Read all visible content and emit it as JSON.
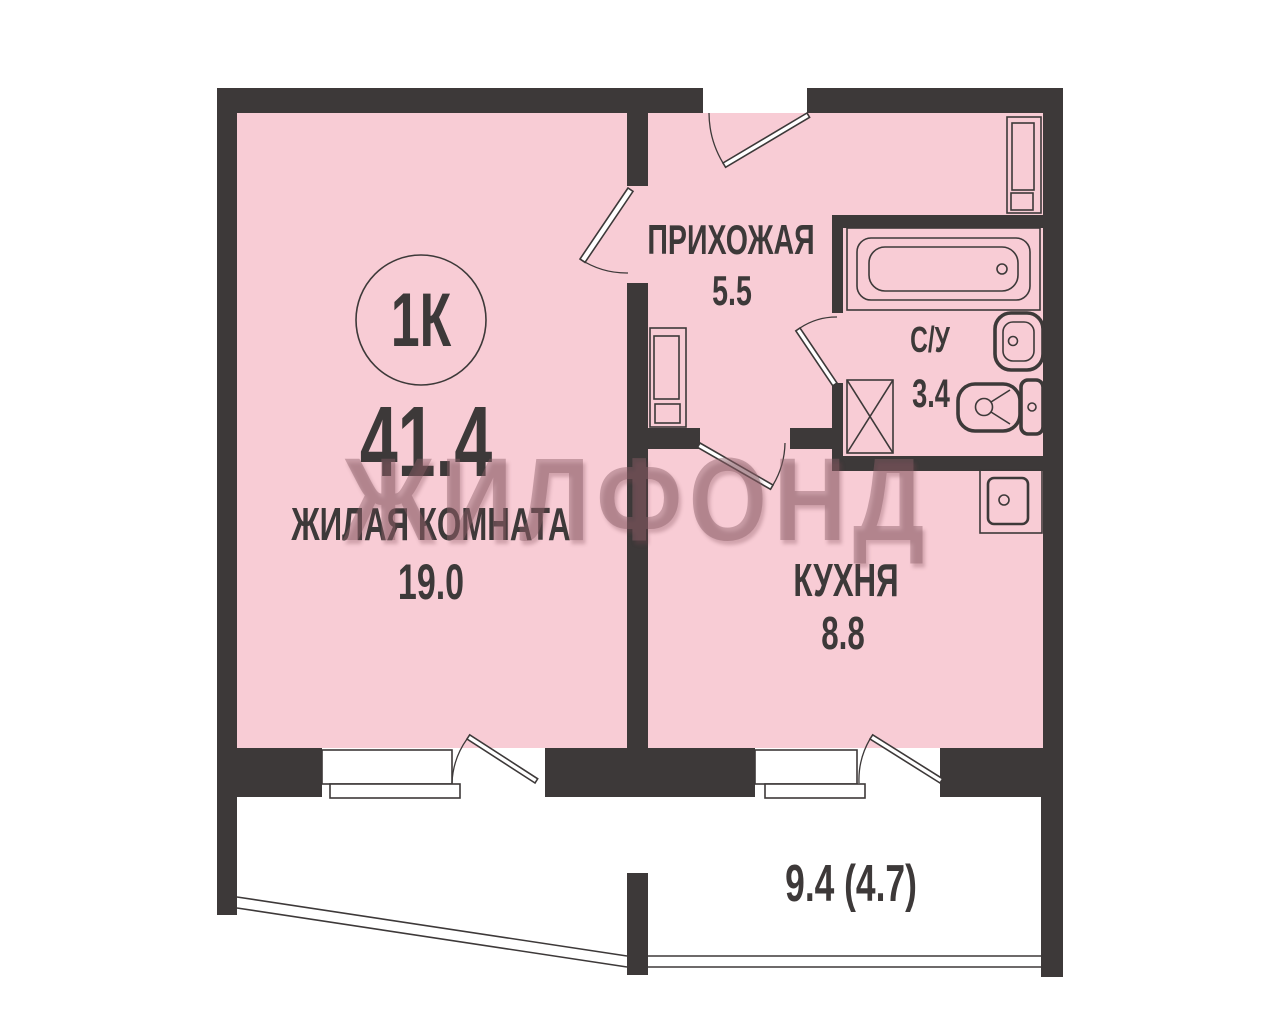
{
  "plan": {
    "type_badge": "1К",
    "total_area": "41.4",
    "watermark": "ЖИЛФОНД",
    "rooms": [
      {
        "name": "ЖИЛАЯ КОМНАТА",
        "area": "19.0"
      },
      {
        "name": "ПРИХОЖАЯ",
        "area": "5.5"
      },
      {
        "name": "С/У",
        "area": "3.4"
      },
      {
        "name": "КУХНЯ",
        "area": "8.8"
      }
    ],
    "balcony_area": "9.4 (4.7)",
    "fixtures": [
      "bathtub-icon",
      "wc-sink-icon",
      "toilet-icon",
      "shower-box-icon",
      "kitchen-sink-icon",
      "hall-cabinet-icon",
      "wardrobe-icon",
      "window-icon",
      "door-swing-icon",
      "balcony-railing-icon"
    ]
  },
  "colors": {
    "bg": "#ffffff",
    "wall": "#3d3939",
    "room": "#f8ccd5",
    "ink": "#3d3939",
    "wm": "rgba(140,95,105,0.45)",
    "wm-shadow": "rgba(120,70,80,0.30)"
  }
}
